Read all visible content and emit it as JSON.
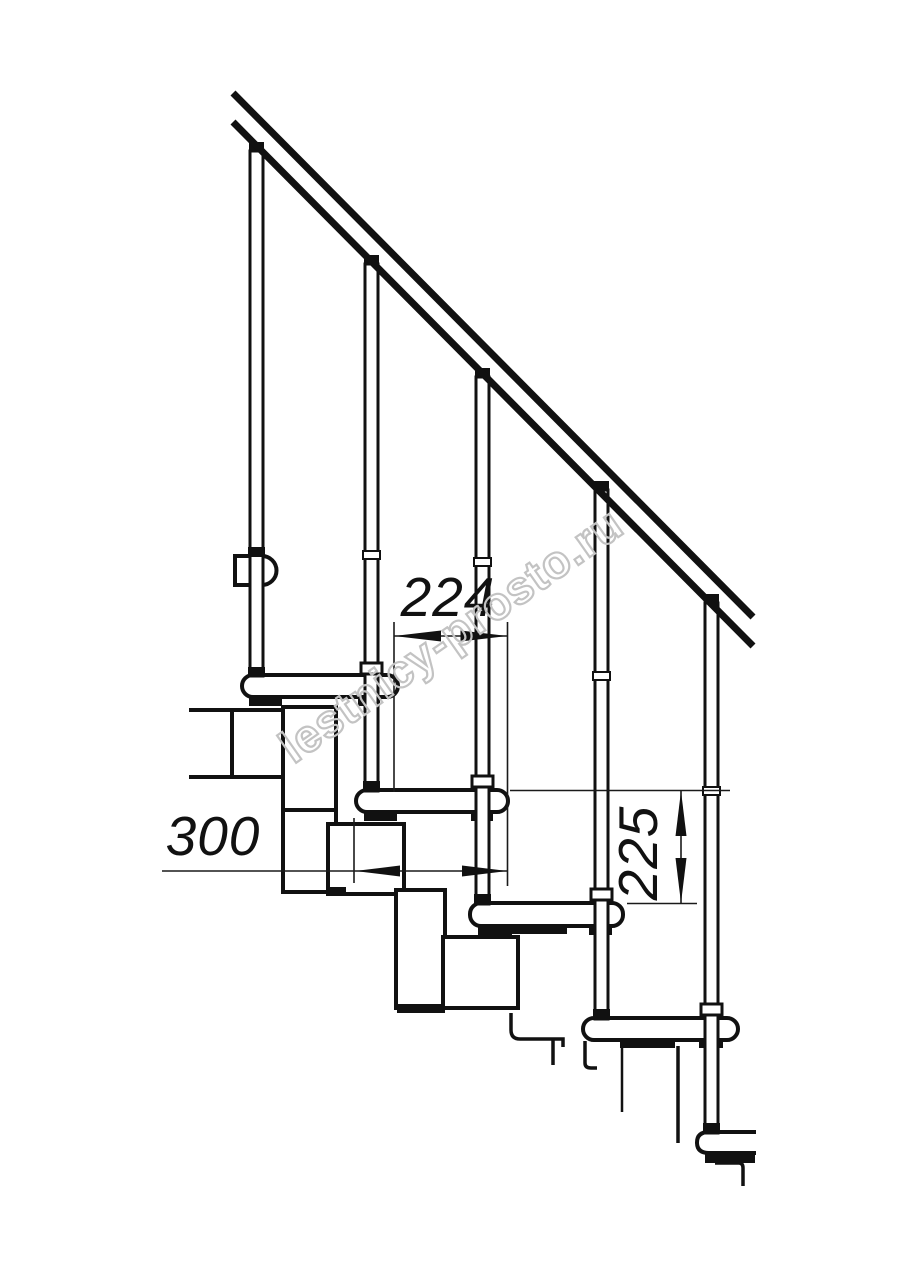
{
  "drawing": {
    "type": "technical-diagram",
    "subject": "modular staircase side elevation",
    "ink_color": "#111111",
    "dimensions": {
      "tread_offset": {
        "label": "224",
        "orientation": "horizontal"
      },
      "tread_length": {
        "label": "300",
        "orientation": "horizontal"
      },
      "step_rise": {
        "label": "225",
        "orientation": "vertical"
      }
    },
    "watermark": {
      "text": "lestnicy-prosto.ru",
      "color": "#c3c3c3"
    }
  }
}
